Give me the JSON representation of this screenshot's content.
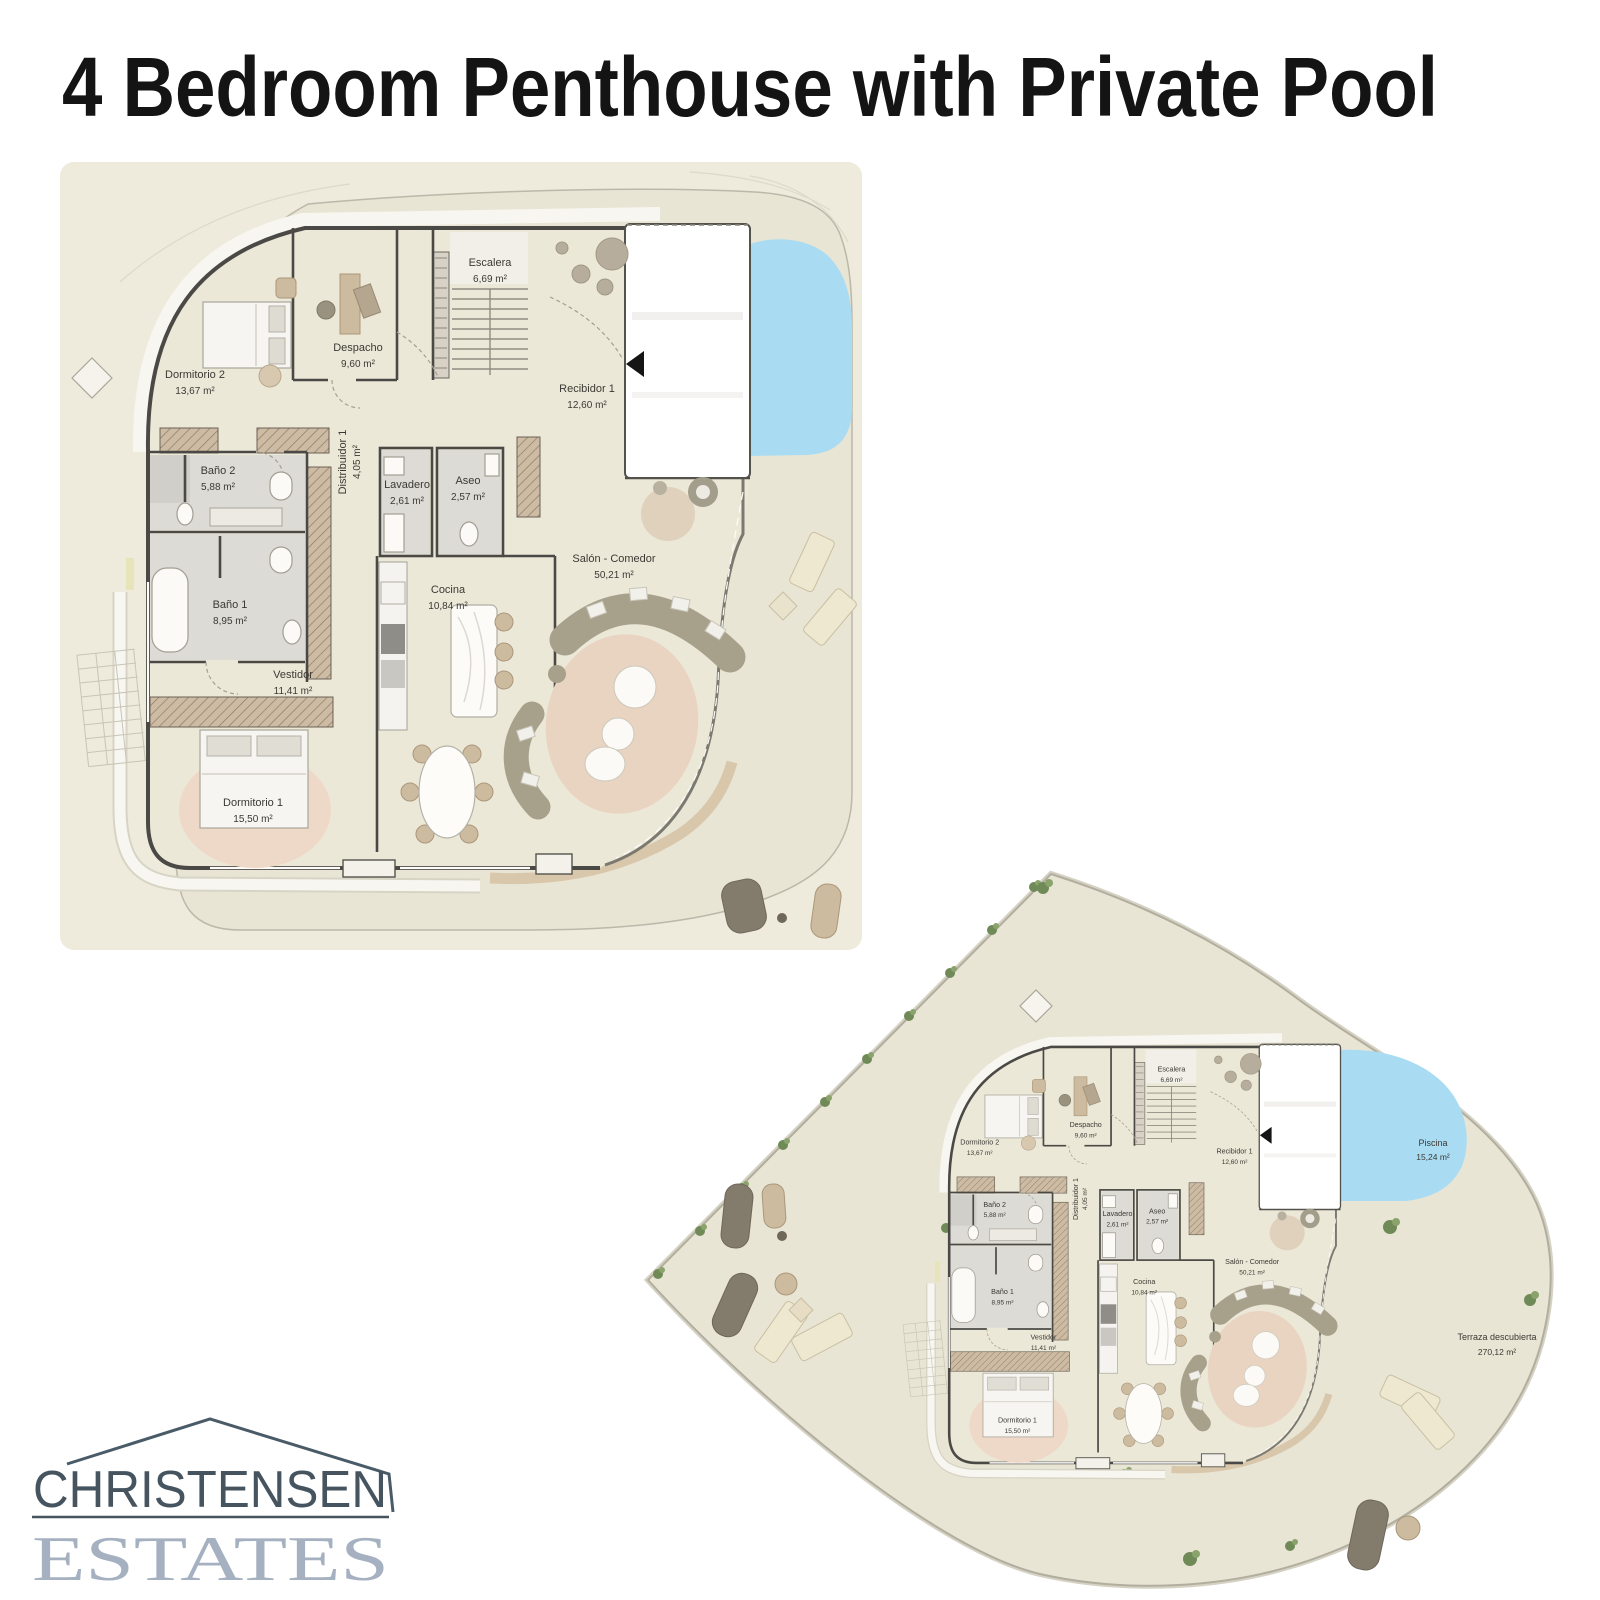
{
  "title": "4 Bedroom Penthouse with Private Pool",
  "plan_labels": {
    "dormitorio2": {
      "name": "Dormitorio 2",
      "area": "13,67 m²"
    },
    "despacho": {
      "name": "Despacho",
      "area": "9,60 m²"
    },
    "escalera": {
      "name": "Escalera",
      "area": "6,69 m²"
    },
    "recibidor1": {
      "name": "Recibidor 1",
      "area": "12,60 m²"
    },
    "distribuidor1": {
      "name": "Distribuidor 1",
      "area": "4,05 m²"
    },
    "lavadero": {
      "name": "Lavadero",
      "area": "2,61 m²"
    },
    "aseo": {
      "name": "Aseo",
      "area": "2,57 m²"
    },
    "bano2": {
      "name": "Baño 2",
      "area": "5,88 m²"
    },
    "bano1": {
      "name": "Baño 1",
      "area": "8,95 m²"
    },
    "vestidor": {
      "name": "Vestidor",
      "area": "11,41 m²"
    },
    "dormitorio1": {
      "name": "Dormitorio 1",
      "area": "15,50 m²"
    },
    "cocina": {
      "name": "Cocina",
      "area": "10,84 m²"
    },
    "salon": {
      "name": "Salón - Comedor",
      "area": "50,21 m²"
    }
  },
  "terrace_labels": {
    "piscina": {
      "name": "Piscina",
      "area": "15,24 m²"
    },
    "terraza": {
      "name": "Terraza descubierta",
      "area": "270,12 m²"
    }
  },
  "logo": {
    "name": "CHRISTENSEN",
    "tagline": "ESTATES"
  },
  "colors": {
    "pool_blue": "#a9dcf2",
    "terrace_beige": "#e9e5d4",
    "apartment_floor": "#ece8d8",
    "wall_gray": "#4b4945",
    "hedge_green": "#6f8a57",
    "logo_primary": "#45545f",
    "logo_secondary": "#a5b1c0",
    "title_color": "#141414"
  }
}
